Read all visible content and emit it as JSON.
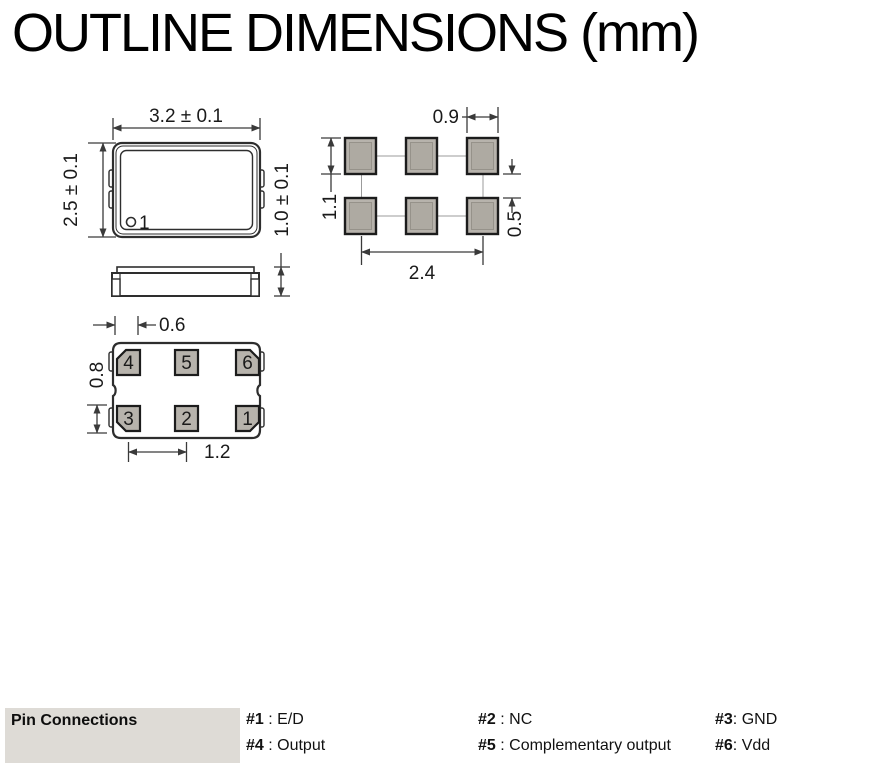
{
  "title": "OUTLINE DIMENSIONS (mm)",
  "top_view": {
    "width_dim": "3.2 ± 0.1",
    "height_dim": "2.5 ± 0.1",
    "thickness_dim": "1.0 ± 0.1",
    "pin1_marker": "1"
  },
  "land_pattern": {
    "pad_width_dim": "0.9",
    "pad_height_dim": "1.1",
    "row_gap_dim": "0.5",
    "span_dim": "2.4"
  },
  "bottom_view": {
    "pad_width_dim": "0.6",
    "pad_height_dim": "0.8",
    "pitch_dim": "1.2",
    "pin_numbers_top": [
      "4",
      "5",
      "6"
    ],
    "pin_numbers_bottom": [
      "3",
      "2",
      "1"
    ]
  },
  "pin_connections": {
    "heading": "Pin Connections",
    "entries": [
      {
        "pin": "#1",
        "desc": " : E/D"
      },
      {
        "pin": "#2",
        "desc": " : NC"
      },
      {
        "pin": "#3",
        "desc": ": GND"
      },
      {
        "pin": "#4",
        "desc": " : Output"
      },
      {
        "pin": "#5",
        "desc": " : Complementary output"
      },
      {
        "pin": "#6",
        "desc": ": Vdd"
      }
    ]
  },
  "colors": {
    "pad_fill": "#b7b3ac",
    "pad_fill_inner": "#aeaaa2",
    "dimension_line": "#3a3a3a",
    "outline": "#2e2e2e",
    "pin_block_bg": "#dedbd6"
  }
}
